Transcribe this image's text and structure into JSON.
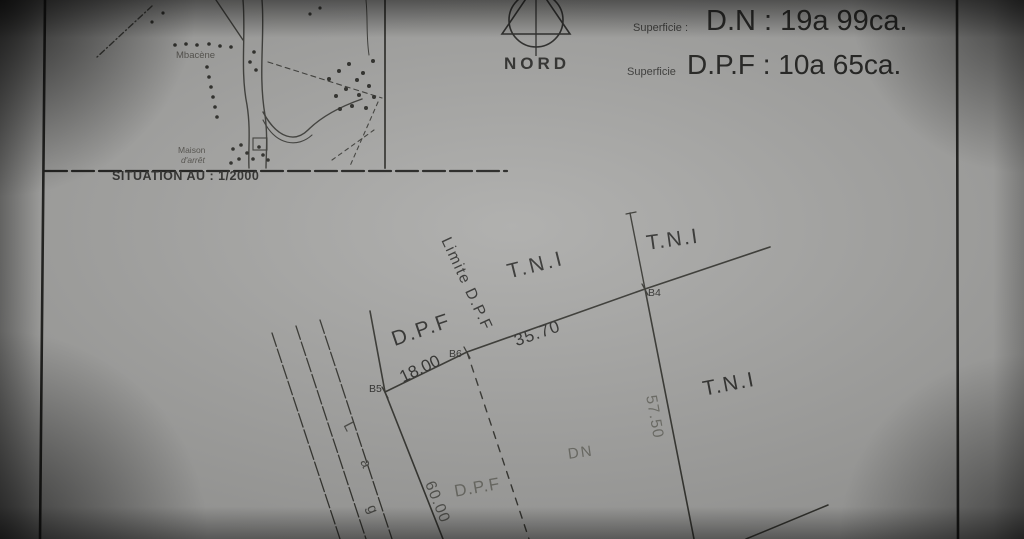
{
  "map": {
    "caption": "SITUATION AU : 1/2000",
    "label_village": "Mbacène",
    "label_maison_line1": "Maison",
    "label_maison_line2": "d'arrêt"
  },
  "compass": {
    "label": "NORD"
  },
  "areas": {
    "row1_label": "Superficie :",
    "row1_value": "D.N : 19a 99ca.",
    "row2_label": "Superficie",
    "row2_value": "D.P.F : 10a 65ca."
  },
  "plot": {
    "zone_tni_center": "T.N.I",
    "zone_tni_top_right": "T.N.I",
    "zone_tni_right": "T.N.I",
    "zone_dpf_top": "D.P.F",
    "zone_dpf_bottom": "D.P.F",
    "zone_dn": "DN",
    "limite_label": "Limite D.P.F",
    "point_b4": "B4",
    "point_b5": "B5",
    "point_b6": "B6",
    "len_b5_b6": "18.00",
    "len_b6_b4": "35.70",
    "len_right": "57.50",
    "len_left": "60.00",
    "lag_letters": [
      "L",
      "a",
      "g"
    ]
  },
  "colors": {
    "paper": "#a8a8a6",
    "ink": "#2e2e2c",
    "faint_ink": "#6d6d66"
  }
}
